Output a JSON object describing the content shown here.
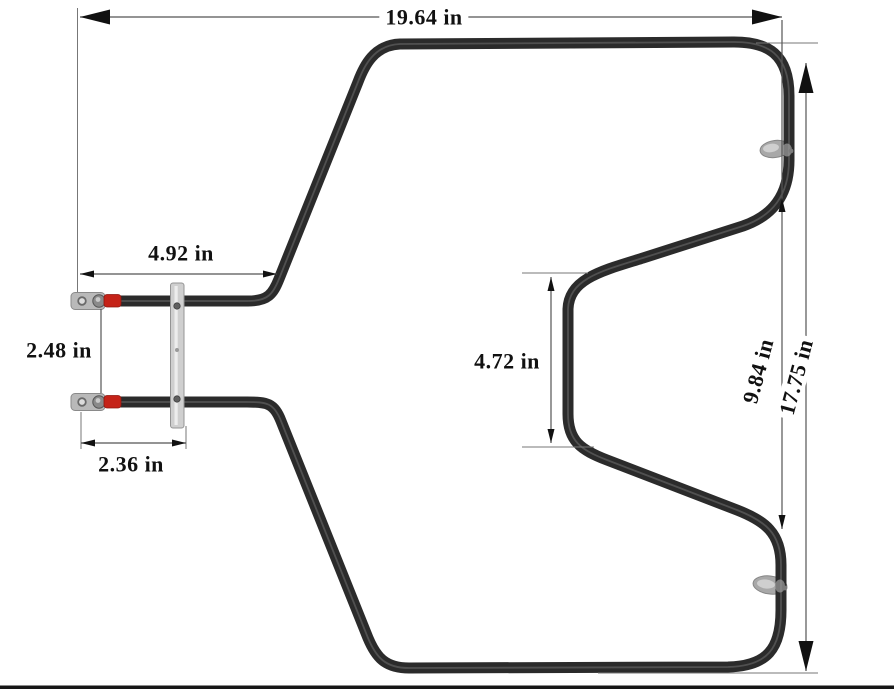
{
  "dimensions": {
    "overall_width": "19.64 in",
    "overall_height": "17.75 in",
    "right_side_span": "9.84 in",
    "terminal_reach": "4.92 in",
    "terminal_spacing": "2.48 in",
    "terminal_to_bracket": "2.36 in",
    "center_notch_height": "4.72 in"
  },
  "colors": {
    "background": "#ffffff",
    "element_tube": "#2b2b2b",
    "tube_highlight": "#5a5a5a",
    "terminal_metal": "#b9b9b9",
    "wire_sleeve_red": "#c52318",
    "bracket_metal": "#cfcfcf",
    "grommet_metal": "#a8a8a8",
    "dimension_line": "#555555",
    "label_text": "#111111",
    "bottom_border": "#161616"
  }
}
